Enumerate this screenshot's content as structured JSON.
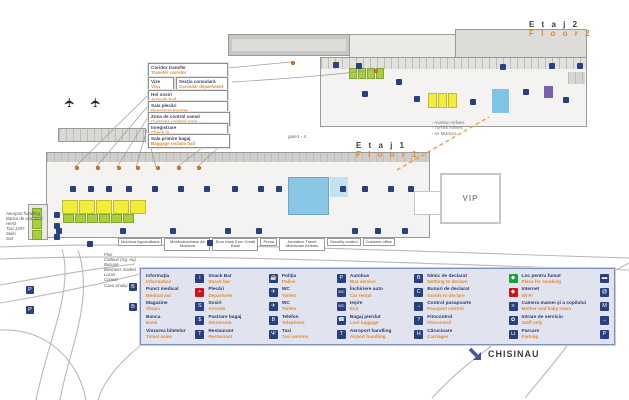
{
  "floor2": {
    "label_ro": "E t a j  2",
    "label_en": "F l o o r  2",
    "airlines": [
      "Austrian Airlines",
      "Turkish Airlines",
      "Air Moldova"
    ]
  },
  "floor1": {
    "label_ro": "E t a j  1",
    "label_en": "F l o o r  1",
    "gate_label": "gate1 - 4",
    "vip_label": "VIP"
  },
  "city": {
    "label": "CHISINAU",
    "arrow_icon": "arrow-down-right-icon"
  },
  "callouts": [
    {
      "ro": "Coridor transfer",
      "en": "Transfer corridor"
    },
    {
      "ro": "Vize",
      "en": "Visa"
    },
    {
      "ro": "Secţia consulară",
      "en": "Consular department"
    },
    {
      "ro": "Hol sosiri",
      "en": "Arrivals hall"
    },
    {
      "ro": "Sala plecări",
      "en": "Departure lounge"
    },
    {
      "ro": "Zona de control vamal",
      "en": "Customs control zone"
    },
    {
      "ro": "Inregistrare",
      "en": "Check in"
    },
    {
      "ro": "Sala primire bagaj",
      "en": "Baggage reclaim hall"
    }
  ],
  "facility_labels": [
    "Moldova Agroindbank",
    "Moldindconbank Air Moldova",
    "Euro bank Euro Credit Bank",
    "Presa",
    "Amadeus Travel Moldavian Airlines",
    "Security control",
    "Customs office"
  ],
  "left_services": [
    "Aeroport handling",
    "Banca de economii",
    "Hertz",
    "Taxi 1407",
    "Solei",
    "Sixt"
  ],
  "shops": [
    "Flori",
    "Cadouri (Ag. Au)",
    "Bucurie",
    "Business market",
    "Luran",
    "Conext",
    "Casa vinului"
  ],
  "legend": {
    "columns": [
      [
        {
          "ro": "Informaţia",
          "en": "Information",
          "icon": "i",
          "icon_name": "info-icon"
        },
        {
          "ro": "Punct medical",
          "en": "Medical aid",
          "icon": "+",
          "icon_name": "medical-icon",
          "bg": "#c8161d"
        },
        {
          "ro": "Magazine",
          "en": "Shops",
          "icon": "S",
          "icon_name": "shops-icon"
        },
        {
          "ro": "Banca",
          "en": "Bank",
          "icon": "$",
          "icon_name": "bank-icon"
        },
        {
          "ro": "Vinzarea biletelor",
          "en": "Ticket sales",
          "icon": "T",
          "icon_name": "ticket-sales-icon"
        }
      ],
      [
        {
          "ro": "Snack Bar",
          "en": "Snack bar",
          "icon": "☕",
          "icon_name": "snack-bar-icon"
        },
        {
          "ro": "Plecări",
          "en": "Departures",
          "icon": "✈",
          "icon_name": "departures-icon"
        },
        {
          "ro": "Sosiri",
          "en": "Arrivals",
          "icon": "✈",
          "icon_name": "arrivals-icon"
        },
        {
          "ro": "Pastrare bagaj",
          "en": "Storeroom",
          "icon": "B",
          "icon_name": "storeroom-icon"
        },
        {
          "ro": "Restaurant",
          "en": "Restaurant",
          "icon": "Ψ",
          "icon_name": "restaurant-icon"
        }
      ],
      [
        {
          "ro": "Poliţia",
          "en": "Police",
          "icon": "P",
          "icon_name": "police-icon"
        },
        {
          "ro": "WC",
          "en": "Toilets",
          "icon": "WC",
          "icon_name": "wc-icon"
        },
        {
          "ro": "WC",
          "en": "Toilets",
          "icon": "WC",
          "icon_name": "wc-icon"
        },
        {
          "ro": "Telefon",
          "en": "Telephone",
          "icon": "☎",
          "icon_name": "telephone-icon"
        },
        {
          "ro": "Taxi",
          "en": "Taxi service",
          "icon": "T",
          "icon_name": "taxi-icon"
        }
      ],
      [
        {
          "ro": "Autobus",
          "en": "Bus service",
          "icon": "B",
          "icon_name": "bus-icon"
        },
        {
          "ro": "Închiriere auto",
          "en": "Car rental",
          "icon": "C",
          "icon_name": "car-rental-icon"
        },
        {
          "ro": "Ieşire",
          "en": "Exit",
          "icon": "→",
          "icon_name": "exit-icon"
        },
        {
          "ro": "Bagaj pierdut",
          "en": "Lost luggage",
          "icon": "?",
          "icon_name": "lost-luggage-icon"
        },
        {
          "ro": "Aeroport handling",
          "en": "Airport handling",
          "icon": "H",
          "icon_name": "airport-handling-icon"
        }
      ],
      [
        {
          "ro": "Nimic de declarat",
          "en": "Nothing to declare",
          "icon": "◆",
          "icon_name": "nothing-to-declare-icon",
          "bg": "#1f9d3a"
        },
        {
          "ro": "Bunuri de declarat",
          "en": "Goods to declare",
          "icon": "◆",
          "icon_name": "goods-to-declare-icon",
          "bg": "#c8161d"
        },
        {
          "ro": "Control pasapoarte",
          "en": "Passport control",
          "icon": "≡",
          "icon_name": "passport-control-icon"
        },
        {
          "ro": "Fitocontrol",
          "en": "Fitocontrol",
          "icon": "✿",
          "icon_name": "fitocontrol-icon"
        },
        {
          "ro": "Cărucioare",
          "en": "Carriages",
          "icon": "⊔",
          "icon_name": "carriages-icon"
        }
      ],
      [
        {
          "ro": "Loc pentru fumat",
          "en": "Place for smoking",
          "icon": "▬",
          "icon_name": "smoking-icon"
        },
        {
          "ro": "Internet",
          "en": "Wi-Fi",
          "icon": "@",
          "icon_name": "wifi-icon"
        },
        {
          "ro": "Camera mamei şi a copilului",
          "en": "Mother and baby room",
          "icon": "M",
          "icon_name": "mother-baby-icon"
        },
        {
          "ro": "Intrare de serviciu",
          "en": "Staff only",
          "icon": "→",
          "icon_name": "staff-entrance-icon"
        },
        {
          "ro": "Parcare",
          "en": "Parking",
          "icon": "P",
          "icon_name": "parking-icon"
        }
      ]
    ]
  },
  "road_icons": [
    {
      "glyph": "P",
      "icon_name": "parking-icon"
    },
    {
      "glyph": "P",
      "icon_name": "parking-icon"
    },
    {
      "glyph": "B",
      "icon_name": "bus-stop-icon"
    },
    {
      "glyph": "B",
      "icon_name": "bus-stop-icon"
    }
  ],
  "colors": {
    "accent_orange": "#e8872a",
    "navy": "#26417e",
    "legend_bg": "#e0e4ee",
    "medical_red": "#c8161d",
    "declare_green": "#1f9d3a",
    "plan_yellow": "#f3ec3b",
    "plan_green": "#a8cf3d",
    "plan_blue": "#8ac7e6",
    "road_gray": "#b9b9b9"
  }
}
